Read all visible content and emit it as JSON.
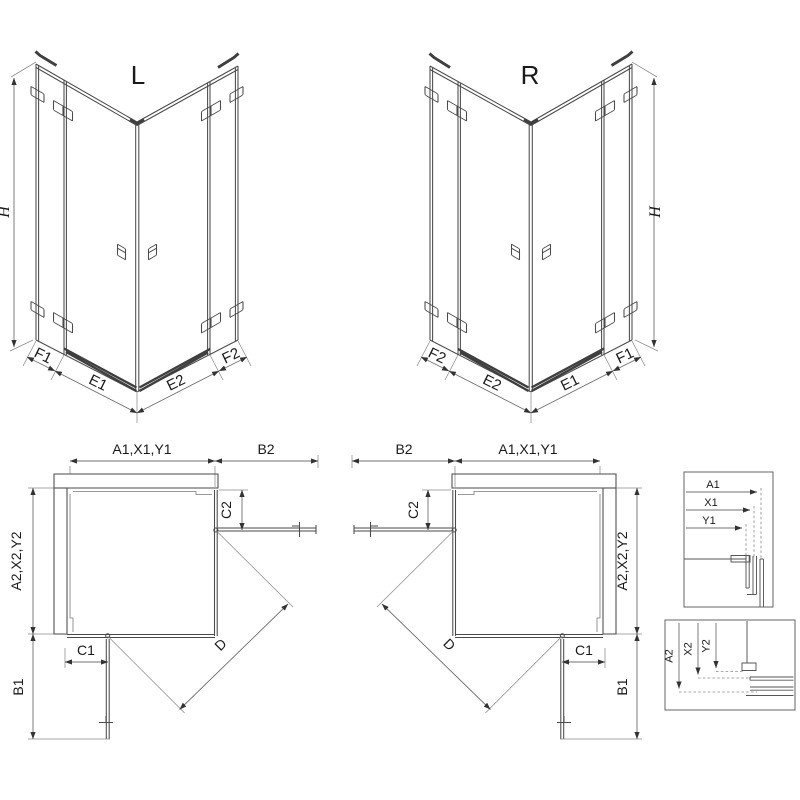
{
  "colors": {
    "line": "#4a4a4a",
    "dimension": "#707070",
    "hatch": "#9a9a9a",
    "threshold": "#3f3f3f",
    "text": "#1a1a1a",
    "background": "#ffffff"
  },
  "iso_left": {
    "title": "L",
    "height_label": "H",
    "bottom_labels": [
      "F1",
      "E1",
      "E2",
      "F2"
    ]
  },
  "iso_right": {
    "title": "R",
    "height_label": "H",
    "bottom_labels": [
      "F2",
      "E2",
      "E1",
      "F1"
    ]
  },
  "plan_left": {
    "top_width": "A1,X1,Y1",
    "top_extension": "B2",
    "upper_panel": "C2",
    "side_depth": "A2,X2,Y2",
    "lower_panel": "C1",
    "side_extension": "B1",
    "diagonal": "D"
  },
  "plan_right": {
    "top_extension": "B2",
    "top_width": "A1,X1,Y1",
    "upper_panel": "C2",
    "side_depth": "A2,X2,Y2",
    "lower_panel": "C1",
    "side_extension": "B1",
    "diagonal": "D"
  },
  "detail_width_profile": {
    "dims": [
      "A1",
      "X1",
      "Y1"
    ]
  },
  "detail_depth_profile": {
    "dims": [
      "A2",
      "X2",
      "Y2"
    ]
  }
}
